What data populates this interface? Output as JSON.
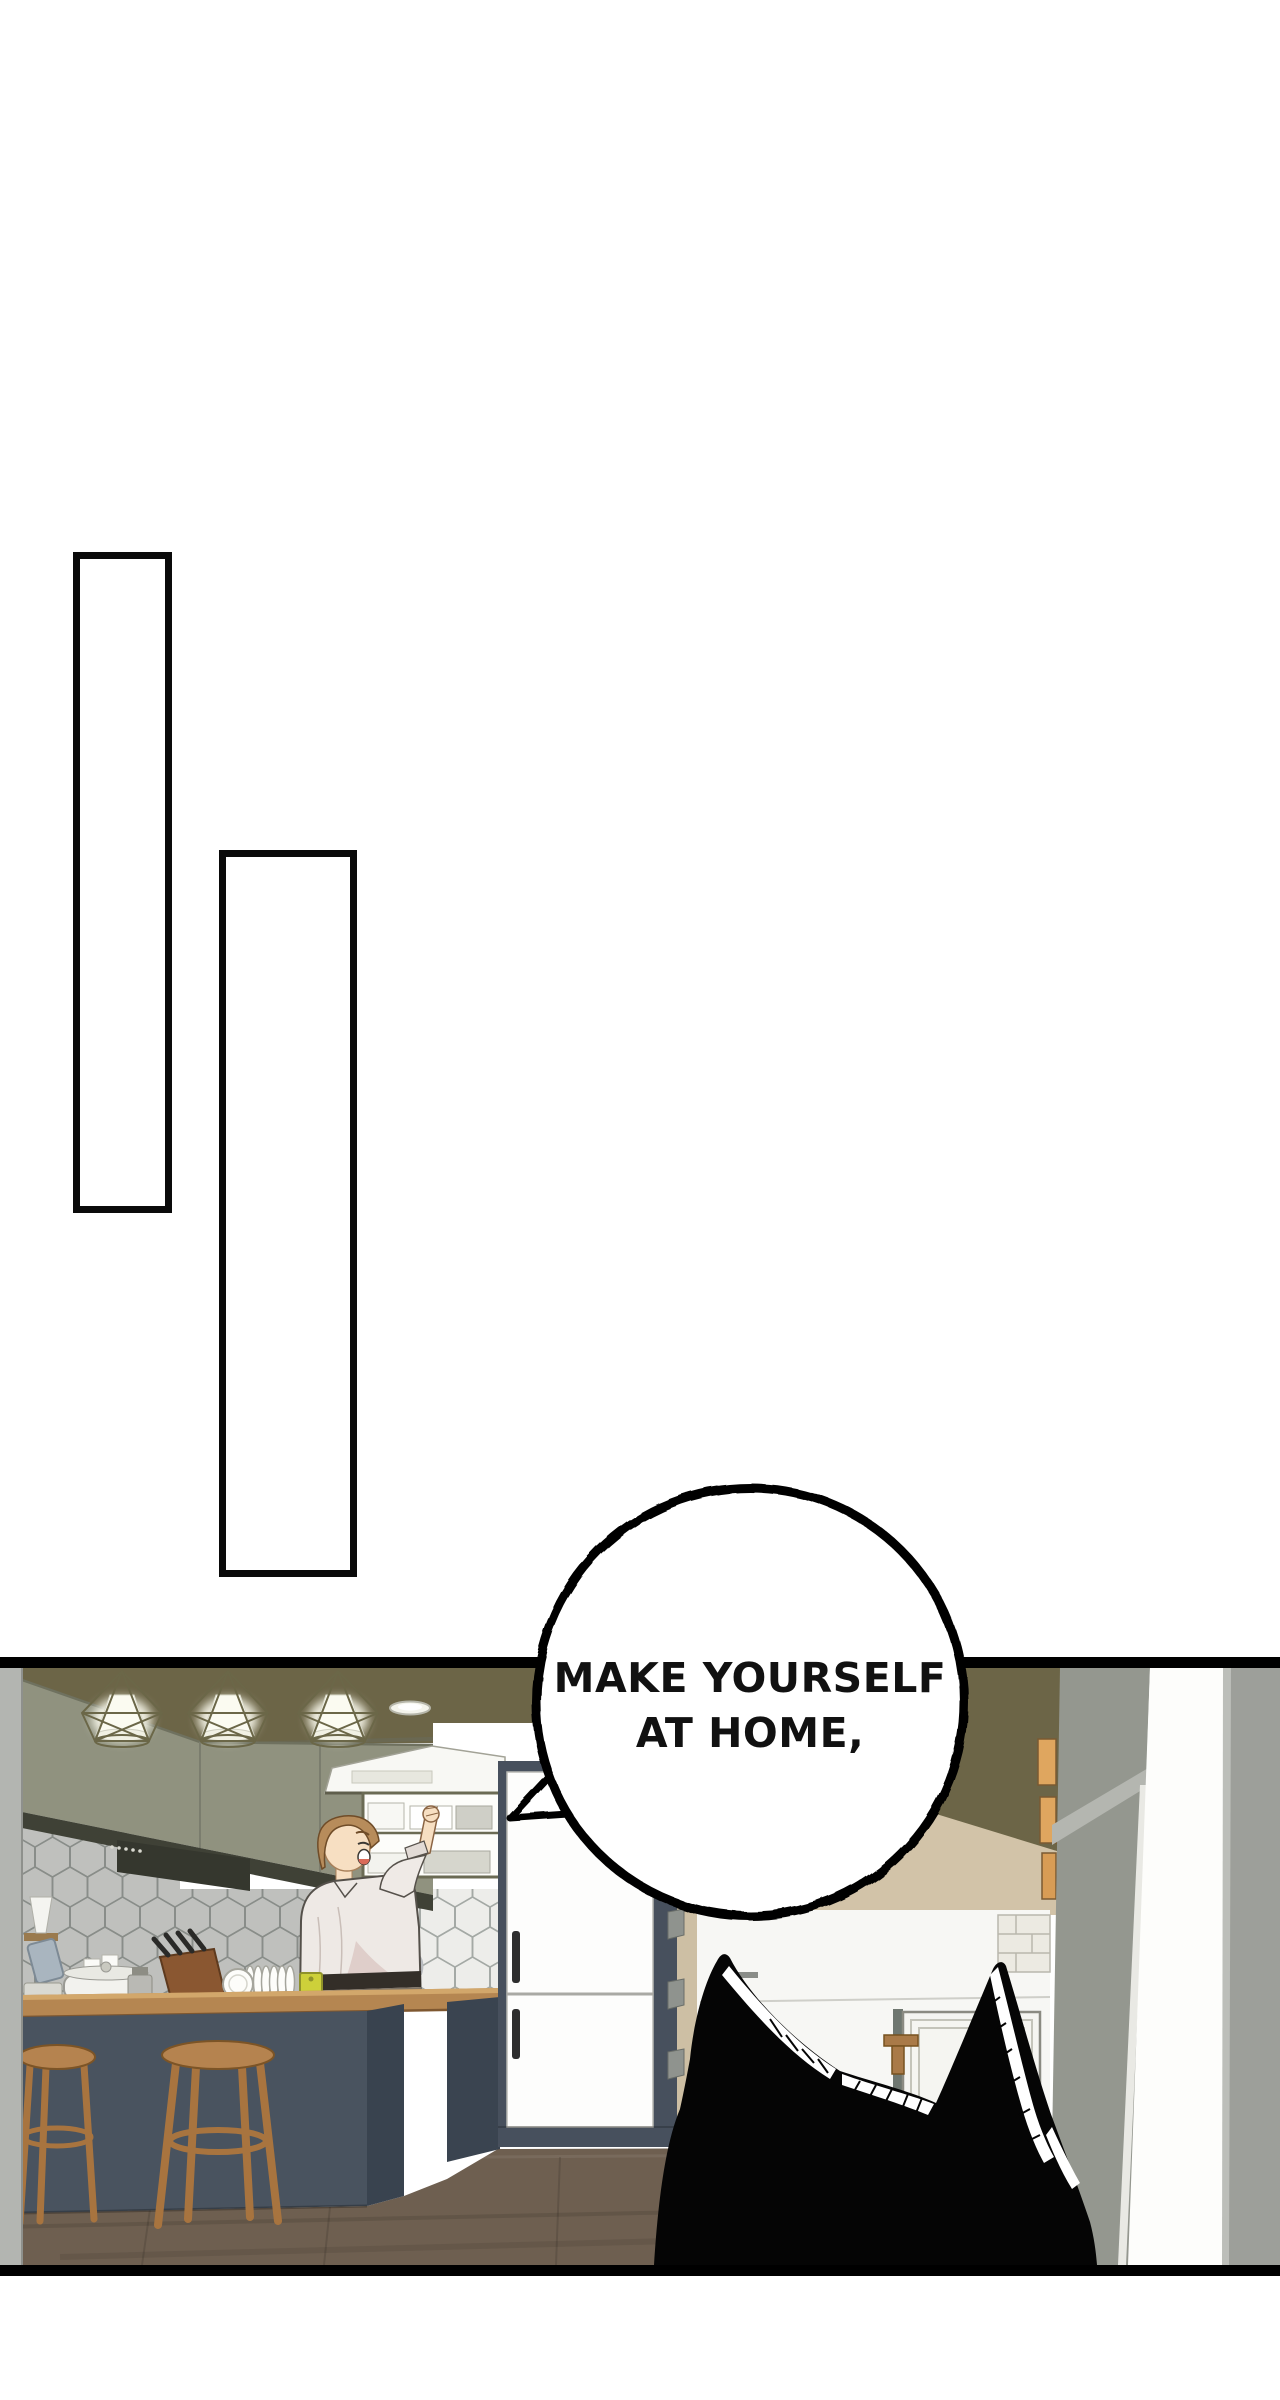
{
  "page": {
    "type": "webtoon comic page",
    "background": "#ffffff"
  },
  "speech_bubble": {
    "line1": "MAKE YOURSELF",
    "line2": "AT HOME,",
    "fill": "#ffffff",
    "stroke": "#000000",
    "text_color": "#111111"
  },
  "panels": {
    "panel_1": {
      "kind": "empty rectangle panel"
    },
    "panel_2": {
      "kind": "empty rectangle panel"
    },
    "panel_3": {
      "kind": "kitchen scene",
      "description": "Man happily reaching into an upper open shelf in a kitchen, seen from behind the silhouetted ears of a black cat in the foreground."
    }
  },
  "scene_palette": {
    "ceiling_olive": "#6c6547",
    "cabinet_gray": "#90927f",
    "tile": "#ededea",
    "tile_grout": "#a4a9a5",
    "island_navy": "#49535f",
    "counter_wood": "#b58651",
    "stool_wood": "#b5834f",
    "floor_brown": "#6e5f50",
    "tan_wall": "#d2c3a8",
    "hutch_gray": "#94978f",
    "right_wall_gray": "#9d9f9a",
    "books_orange": "#dfa65f",
    "board_yellow": "#cdd03a",
    "skin": "#f7dfc2",
    "hair_brown": "#b78c5b",
    "shirt": "#eee9e5",
    "cat_black": "#050505"
  },
  "scene_elements": [
    "pendant-lights",
    "ceiling-light",
    "upper-cabinets",
    "range-hood",
    "open-shelf",
    "hex-tile-backsplash",
    "window",
    "man-reaching-up",
    "sink-faucet",
    "counter-items",
    "kitchen-island",
    "bar-stools",
    "built-in-fridge",
    "orange-books",
    "gray-hutch",
    "doorway",
    "white-door",
    "brick-half-wall",
    "wood-floor",
    "black-cat-silhouette"
  ]
}
